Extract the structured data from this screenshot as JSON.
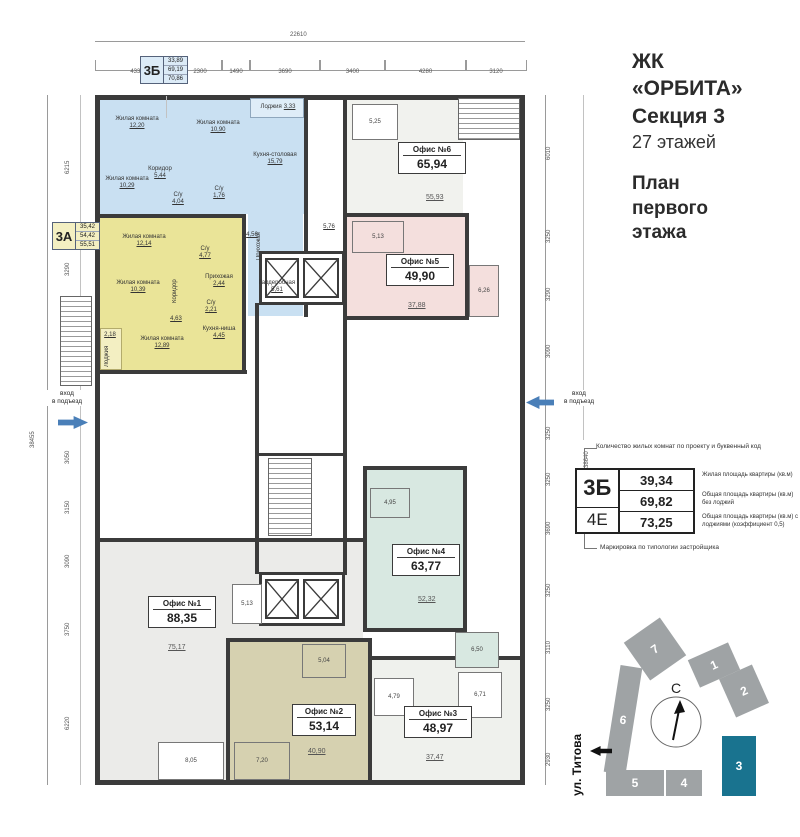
{
  "header": {
    "title_lines": [
      "ЖК",
      "«ОРБИТА»",
      "Секция 3"
    ],
    "floors": "27 этажей",
    "plan_lines": [
      "План",
      "первого",
      "этажа"
    ]
  },
  "legend": {
    "top_note": "Количество жилых комнат по проекту и буквенный код",
    "bottom_note": "Маркировка по типологии застройщика",
    "codes": [
      "3Б",
      "4Е"
    ],
    "values": [
      "39,34",
      "69,82",
      "73,25"
    ],
    "notes": [
      "Жилая площадь квартиры (кв.м)",
      "Общая площадь квартиры (кв.м) без лоджий",
      "Общая площадь квартиры (кв.м) с лоджиями (коэффициент 0,5)"
    ]
  },
  "site_plan": {
    "street": "ул. Титова",
    "compass": "С",
    "blocks": [
      "1",
      "2",
      "3",
      "4",
      "5",
      "6",
      "7"
    ],
    "active_block": "3"
  },
  "dims": {
    "top_total": "22610",
    "top": [
      "4330",
      "2300",
      "1490",
      "3690",
      "3400",
      "4280",
      "3120"
    ],
    "left": [
      "6215",
      "3290",
      "3160",
      "3050",
      "3150",
      "3090",
      "3750",
      "6220"
    ],
    "left_total": "38455",
    "right": [
      "6010",
      "3250",
      "3290",
      "3090",
      "3250",
      "3250",
      "3690",
      "3250",
      "3110",
      "3250",
      "2930"
    ],
    "right_total": "38640"
  },
  "entrance": {
    "line1": "вход",
    "line2": "в подъезд"
  },
  "apartments": [
    {
      "code": "3Б",
      "values": [
        "33,89",
        "69,19",
        "70,86"
      ],
      "rooms": [
        {
          "name": "Жилая комната",
          "area": "12,20"
        },
        {
          "name": "Жилая комната",
          "area": "10,90"
        },
        {
          "name": "Жилая комната",
          "area": "10,29"
        },
        {
          "name": "Коридор",
          "area": "5,44"
        },
        {
          "name": "С/у",
          "area": "4,04"
        },
        {
          "name": "С/у",
          "area": "1,76"
        },
        {
          "name": "Кухня-столовая",
          "area": "15,79"
        },
        {
          "name": "Лоджия",
          "area": "3,33"
        },
        {
          "name": "Прихожая",
          "area": "4,56"
        },
        {
          "name": "Гардеробная",
          "area": "5,61"
        }
      ]
    },
    {
      "code": "3А",
      "values": [
        "35,42",
        "54,42",
        "55,51"
      ],
      "rooms": [
        {
          "name": "Жилая комната",
          "area": "12,14"
        },
        {
          "name": "Жилая комната",
          "area": "10,39"
        },
        {
          "name": "Жилая комната",
          "area": "12,89"
        },
        {
          "name": "Коридор",
          "area": "4,63"
        },
        {
          "name": "С/у",
          "area": "4,77"
        },
        {
          "name": "С/у",
          "area": "2,21"
        },
        {
          "name": "Прихожая",
          "area": "2,44"
        },
        {
          "name": "Кухня-ниша",
          "area": "4,45"
        },
        {
          "name": "Лоджия",
          "area": "2,18"
        }
      ]
    }
  ],
  "offices": [
    {
      "name": "Офис №1",
      "total": "88,35",
      "main_area": "75,17",
      "rooms": [
        {
          "area": "5,13"
        },
        {
          "area": "8,05"
        }
      ]
    },
    {
      "name": "Офис №2",
      "total": "53,14",
      "main_area": "40,90",
      "rooms": [
        {
          "area": "5,04"
        },
        {
          "area": "7,20"
        }
      ]
    },
    {
      "name": "Офис №3",
      "total": "48,97",
      "main_area": "37,47",
      "rooms": [
        {
          "area": "4,79"
        },
        {
          "area": "6,71"
        }
      ]
    },
    {
      "name": "Офис №4",
      "total": "63,77",
      "main_area": "52,32",
      "rooms": [
        {
          "area": "4,95"
        },
        {
          "area": "6,50"
        }
      ]
    },
    {
      "name": "Офис №5",
      "total": "49,90",
      "main_area": "37,88",
      "rooms": [
        {
          "area": "5,13"
        },
        {
          "area": "5,76"
        },
        {
          "area": "6,26"
        }
      ]
    },
    {
      "name": "Офис №6",
      "total": "65,94",
      "main_area": "55,93",
      "rooms": [
        {
          "area": "5,25"
        }
      ]
    }
  ],
  "colors": {
    "apartment_3b": "#c9e0f2",
    "apartment_3a": "#eae498",
    "office5_pink": "#f4dfdd",
    "office4_teal": "#d8e8e1",
    "office2_khaki": "#d6d1b0",
    "office1_gray": "#ebebe9",
    "wall": "#3b3b3b",
    "entrance_arrow": "#4a7fb8",
    "active_section": "#19738f",
    "section_gray": "#9fa3a5"
  }
}
